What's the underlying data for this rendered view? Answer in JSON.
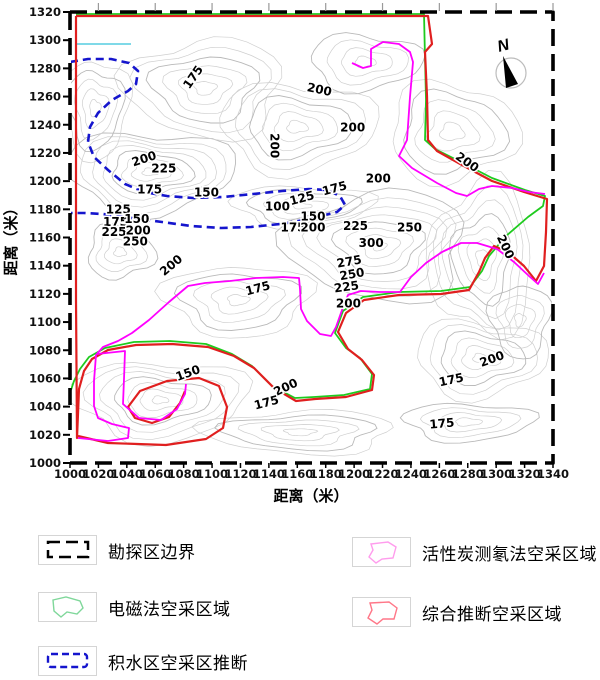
{
  "compass": {
    "label": "N"
  },
  "axes": {
    "x_title": "距离（米）",
    "y_title": "距离（米）",
    "x_ticks": [
      1000,
      1020,
      1040,
      1060,
      1080,
      1100,
      1120,
      1140,
      1160,
      1180,
      1200,
      1220,
      1240,
      1260,
      1280,
      1300,
      1320,
      1340
    ],
    "y_ticks": [
      1320,
      1300,
      1280,
      1260,
      1240,
      1220,
      1200,
      1180,
      1160,
      1140,
      1120,
      1100,
      1080,
      1060,
      1040,
      1020,
      1000
    ]
  },
  "chart_data": {
    "type": "heatmap",
    "subtype": "contour-map",
    "title": "",
    "xlabel": "距离（米）",
    "ylabel": "距离（米）",
    "x_range": [
      1000,
      1340
    ],
    "y_range": [
      1000,
      1320
    ],
    "grid": false,
    "legend_position": "bottom",
    "contour_labels": [
      {
        "v": 175,
        "x": 1089,
        "y": 1275,
        "r": -55
      },
      {
        "v": 200,
        "x": 1175,
        "y": 1265,
        "r": 12
      },
      {
        "v": 200,
        "x": 1199,
        "y": 1238,
        "r": 0
      },
      {
        "v": 200,
        "x": 1141,
        "y": 1228,
        "r": 90
      },
      {
        "v": 200,
        "x": 1053,
        "y": 1216,
        "r": -18
      },
      {
        "v": 225,
        "x": 1066,
        "y": 1209,
        "r": 0
      },
      {
        "v": 175,
        "x": 1056,
        "y": 1194,
        "r": 0
      },
      {
        "v": 150,
        "x": 1096,
        "y": 1192,
        "r": 0
      },
      {
        "v": 175,
        "x": 1187,
        "y": 1195,
        "r": -15
      },
      {
        "v": 200,
        "x": 1217,
        "y": 1202,
        "r": 0
      },
      {
        "v": 100,
        "x": 1146,
        "y": 1182,
        "r": 0
      },
      {
        "v": 125,
        "x": 1164,
        "y": 1188,
        "r": -15
      },
      {
        "v": 125,
        "x": 1034,
        "y": 1180,
        "r": 0
      },
      {
        "v": 175,
        "x": 1032,
        "y": 1171,
        "r": 0
      },
      {
        "v": 150,
        "x": 1047,
        "y": 1173,
        "r": 0
      },
      {
        "v": 225,
        "x": 1031,
        "y": 1164,
        "r": 0
      },
      {
        "v": 200,
        "x": 1048,
        "y": 1165,
        "r": 0
      },
      {
        "v": 250,
        "x": 1046,
        "y": 1157,
        "r": 0
      },
      {
        "v": 175,
        "x": 1157,
        "y": 1167,
        "r": 0
      },
      {
        "v": 200,
        "x": 1171,
        "y": 1167,
        "r": 0
      },
      {
        "v": 150,
        "x": 1171,
        "y": 1175,
        "r": 0
      },
      {
        "v": 225,
        "x": 1201,
        "y": 1168,
        "r": 0
      },
      {
        "v": 250,
        "x": 1239,
        "y": 1167,
        "r": 0
      },
      {
        "v": 300,
        "x": 1212,
        "y": 1156,
        "r": 0
      },
      {
        "v": 275,
        "x": 1197,
        "y": 1143,
        "r": -10
      },
      {
        "v": 250,
        "x": 1199,
        "y": 1134,
        "r": -10
      },
      {
        "v": 225,
        "x": 1195,
        "y": 1125,
        "r": -8
      },
      {
        "v": 200,
        "x": 1196,
        "y": 1113,
        "r": 0
      },
      {
        "v": 200,
        "x": 1278,
        "y": 1214,
        "r": 35
      },
      {
        "v": 200,
        "x": 1304,
        "y": 1155,
        "r": 65
      },
      {
        "v": 200,
        "x": 1073,
        "y": 1141,
        "r": -40
      },
      {
        "v": 175,
        "x": 1133,
        "y": 1124,
        "r": -15
      },
      {
        "v": 150,
        "x": 1084,
        "y": 1064,
        "r": -20
      },
      {
        "v": 200,
        "x": 1153,
        "y": 1054,
        "r": -25
      },
      {
        "v": 175,
        "x": 1139,
        "y": 1043,
        "r": -15
      },
      {
        "v": 175,
        "x": 1269,
        "y": 1059,
        "r": -12
      },
      {
        "v": 175,
        "x": 1262,
        "y": 1028,
        "r": -5
      },
      {
        "v": 200,
        "x": 1298,
        "y": 1074,
        "r": -20
      }
    ],
    "regions": [
      {
        "name": "水域标记",
        "color": "#7fd9e8",
        "width": 2,
        "dash": "",
        "paths": [
          "M77,44 L131,44"
        ]
      },
      {
        "name": "积水区空采区推断",
        "color": "#1515cd",
        "width": 2.6,
        "dash": "8,5",
        "paths": [
          "M70,62 L88,59 L111,59 L129,63 L138,71 L136,84 L128,91 L112,100 L98,113 L90,127 L88,142 L94,157 L108,170 L125,184 L144,192 L167,196 L193,198 L223,197 L253,194 L282,191 L309,189 L327,190 L340,196 L345,205 L337,212 L321,216 L304,220 L280,224 L251,227 L221,228 L191,226 L162,222 L132,218 L103,214 L84,213 L70,213"
        ]
      },
      {
        "name": "电磁法空采区域",
        "color": "#1ecb1e",
        "width": 1.8,
        "dash": "",
        "paths": [
          "M76,14 L424,14 L425,58 L426,100 L425,140 L435,149 L461,162 L492,178 L525,190 L545,196 L543,206 L528,217 L506,236 L489,256 L482,271 L470,287 L441,291 L399,292 L363,297 L343,311 L335,333 L346,348 L360,358 L372,374 L370,389 L344,395 L314,397 L295,398 L272,386 L252,366 L232,354 L206,344 L170,341 L134,342 L105,348 L89,357 L80,369 L74,381 L71,390"
        ]
      },
      {
        "name": "综合推断空采区域",
        "color": "#e01f1f",
        "width": 2.2,
        "dash": "",
        "paths": [
          "M76,16 L428,16 L432,44 L425,52 L427,96 L428,140 L437,151 L462,165 L492,181 L524,192 L547,199 L546,232 L544,266 L536,281 L524,266 L508,252 L494,246 L485,258 L479,272 L469,290 L441,294 L399,295 L364,300 L346,313 L338,332 L348,349 L362,360 L374,375 L372,390 L346,397 L315,399 L296,401 L274,388 L254,368 L234,356 L208,347 L172,344 L136,345 L108,350 L92,359 L84,371 L79,389 L78,414 L77,438 L76,300 L76,16",
          "M78,436 L108,443 L166,445 L206,439 L223,428 L227,407 L219,386 L199,378 L167,381 L140,391 L128,407 L135,418 L152,423 L169,417 L180,403 L185,391"
        ]
      },
      {
        "name": "活性炭测氡法空采区域",
        "color": "#ff00ff",
        "width": 1.8,
        "dash": "",
        "paths": [
          "M352,63 L363,68 L371,66 L371,49 L383,42 L399,44 L410,52 L413,62 L410,97 L407,140 L399,156 L412,168 L437,183 L456,193 L467,196 L479,189 L492,186 L512,188 L529,192 L545,194",
          "M544,273 L538,284 L529,276 L514,262 L497,249 L477,243 L461,243 L442,252 L426,263 L411,277 L400,292 L380,292 L361,291 L348,295 L342,310 L336,327 L331,336 L320,334 L307,321 L301,309 L300,289 L299,278 L283,277 L256,278 L230,281 L205,283 L188,286 L169,302 L149,320 L132,333 L118,341 L103,347 L96,355 L94,381 L94,406 L98,418 L112,424 L129,428 L128,438 L108,441 L88,439 L78,438",
          "M97,354 L125,351 L124,379 L123,404 L139,418 L161,420 L177,409 L185,394 L186,384"
        ]
      },
      {
        "name": "勘探区边界",
        "color": "#000000",
        "width": 3.6,
        "dash": "17,8",
        "paths": [
          "M70,12 H553 V463 H70 Z"
        ]
      }
    ]
  },
  "legend": {
    "items": [
      {
        "label": "勘探区边界",
        "swatch": "boundary",
        "color": "#000000"
      },
      {
        "label": "电磁法空采区域",
        "swatch": "em",
        "color": "#7fd79a"
      },
      {
        "label": "积水区空采区推断",
        "swatch": "water",
        "color": "#1515cd"
      },
      {
        "label": "活性炭测氡法空采区域",
        "swatch": "radon",
        "color": "#ff9ced"
      },
      {
        "label": "综合推断空采区域",
        "swatch": "combined",
        "color": "#ff7788"
      }
    ]
  }
}
